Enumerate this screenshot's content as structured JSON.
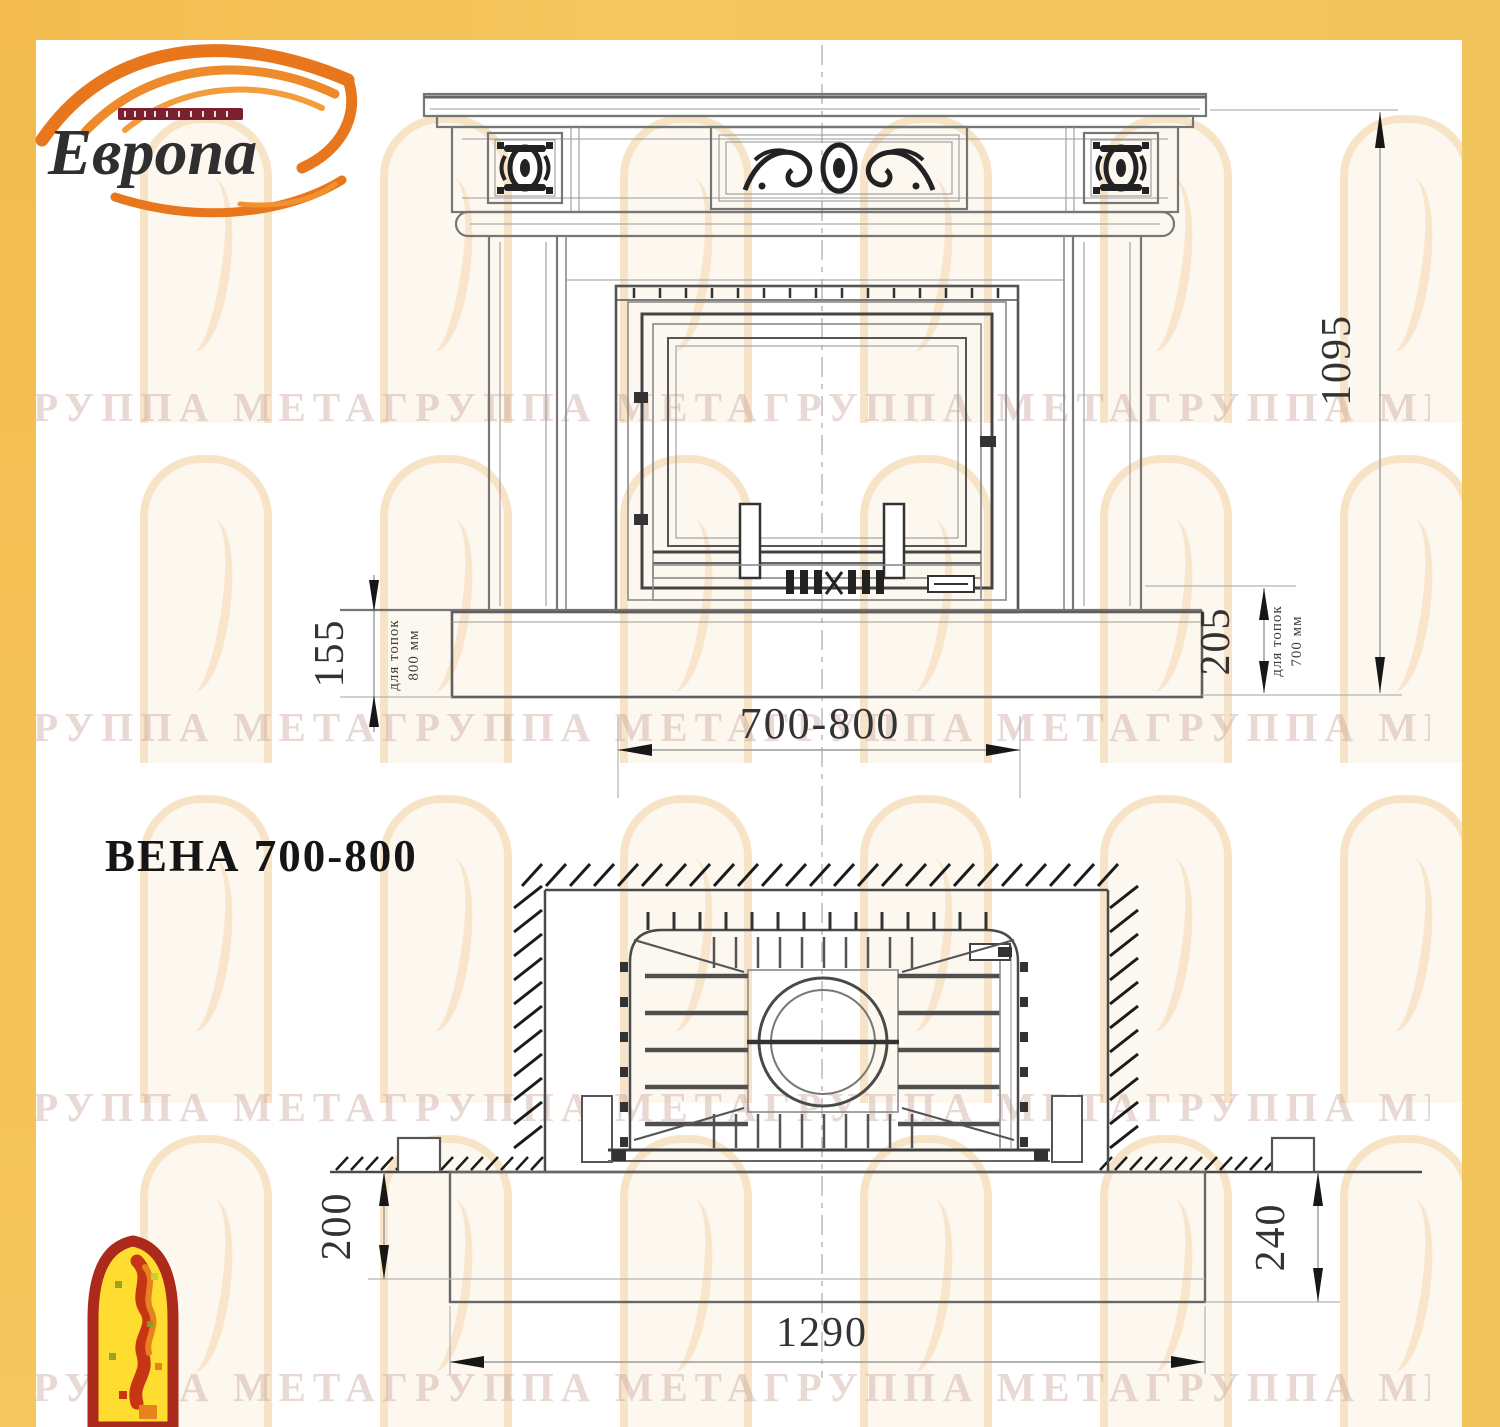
{
  "brand": {
    "name": "Европа"
  },
  "title": "ВЕНА 700-800",
  "watermark": {
    "text": "ГРУППА МЕТАГРУППА МЕТАГРУППА МЕТАГРУППА МЕТАГРУППА МЕТАГРУППА МЕТА"
  },
  "dims": {
    "overall_height": "1095",
    "firebox_width": "700-800",
    "hearth_left": "155",
    "hearth_left_note1": "для топок",
    "hearth_left_note2": "800 мм",
    "hearth_right": "205",
    "hearth_right_note1": "для топок",
    "hearth_right_note2": "700 мм",
    "plan_left": "200",
    "plan_right": "240",
    "plan_width": "1290"
  },
  "colors": {
    "border_yellow": "#F4C55C",
    "logo_red": "#7C2031",
    "flame_orange": "#E8761C",
    "drawing_gray": "#6F6F6F",
    "emblem_red": "#AB2A1C",
    "emblem_yellow": "#FFDD30"
  }
}
